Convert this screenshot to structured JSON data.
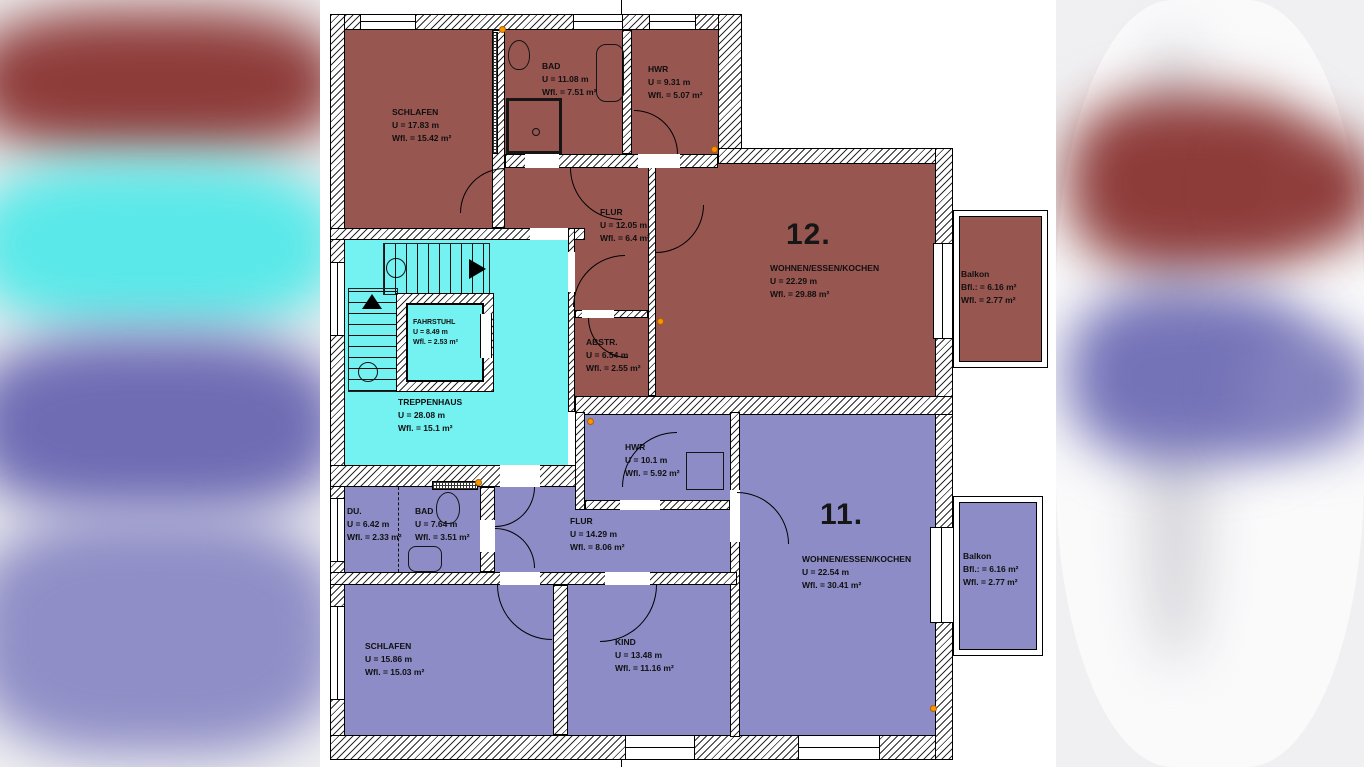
{
  "document_type": "floor-plan",
  "colors": {
    "apartment_12": "#985651",
    "apartment_11": "#8d8cc7",
    "stairwell": "#74f2f2",
    "marker": "#ff9300",
    "paper": "#ffffff"
  },
  "apt12": {
    "number": "12.",
    "rooms": {
      "schlafen": {
        "name": "SCHLAFEN",
        "u": "U = 17.83 m",
        "wfl": "Wfl. = 15.42 m²"
      },
      "bad": {
        "name": "BAD",
        "u": "U = 11.08 m",
        "wfl": "Wfl. = 7.51 m²"
      },
      "hwr": {
        "name": "HWR",
        "u": "U = 9.31 m",
        "wfl": "Wfl. = 5.07 m²"
      },
      "flur": {
        "name": "FLUR",
        "u": "U = 12.05 m",
        "wfl": "Wfl. = 6.4 m²"
      },
      "abstr": {
        "name": "ABSTR.",
        "u": "U = 6.54 m",
        "wfl": "Wfl. = 2.55 m²"
      },
      "wohnen": {
        "name": "WOHNEN/ESSEN/KOCHEN",
        "u": "U = 22.29 m",
        "wfl": "Wfl. = 29.88 m²"
      },
      "balkon": {
        "name": "Balkon",
        "bfl": "Bfl.: = 6.16 m²",
        "wfl": "Wfl. = 2.77 m²"
      }
    }
  },
  "stairwell": {
    "treppenhaus": {
      "name": "TREPPENHAUS",
      "u": "U = 28.08 m",
      "wfl": "Wfl. = 15.1 m²"
    },
    "fahrstuhl": {
      "name": "FAHRSTUHL",
      "u": "U = 8.49 m",
      "wfl": "Wfl. = 2.53 m²"
    }
  },
  "apt11": {
    "number": "11.",
    "rooms": {
      "du": {
        "name": "DU.",
        "u": "U = 6.42 m",
        "wfl": "Wfl. = 2.33 m²"
      },
      "bad": {
        "name": "BAD",
        "u": "U = 7.64 m",
        "wfl": "Wfl. = 3.51 m²"
      },
      "hwr": {
        "name": "HWR",
        "u": "U = 10.1 m",
        "wfl": "Wfl. = 5.92 m²"
      },
      "flur": {
        "name": "FLUR",
        "u": "U = 14.29 m",
        "wfl": "Wfl. = 8.06 m²"
      },
      "schlafen": {
        "name": "SCHLAFEN",
        "u": "U = 15.86 m",
        "wfl": "Wfl. = 15.03 m²"
      },
      "kind": {
        "name": "KIND",
        "u": "U = 13.48 m",
        "wfl": "Wfl. = 11.16 m²"
      },
      "wohnen": {
        "name": "WOHNEN/ESSEN/KOCHEN",
        "u": "U = 22.54 m",
        "wfl": "Wfl. = 30.41 m²"
      },
      "balkon": {
        "name": "Balkon",
        "bfl": "Bfl.: = 6.16 m²",
        "wfl": "Wfl. = 2.77 m²"
      }
    }
  }
}
